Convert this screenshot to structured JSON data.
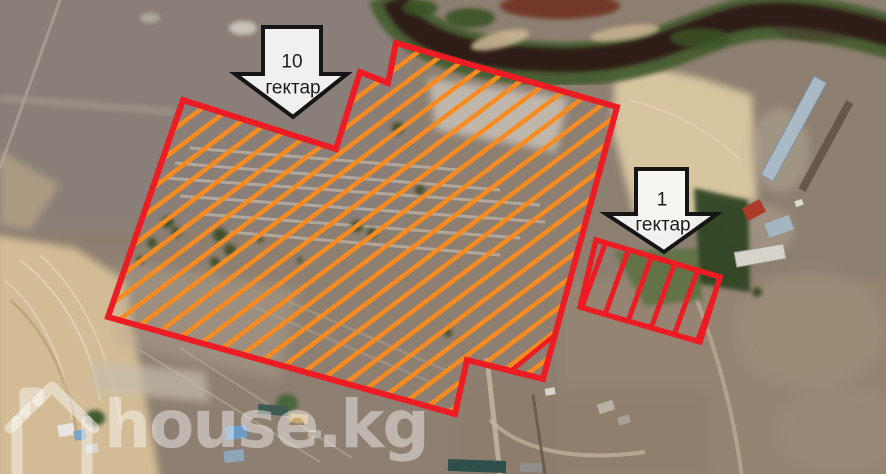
{
  "map": {
    "watermark": {
      "text": "house.kg",
      "icon": "house-outline-icon"
    },
    "plots": [
      {
        "id": "plot-large",
        "label_value": "10",
        "label_unit": "гектар",
        "outline_color": "#ed1c24",
        "hatch_color": "#f78b1f"
      },
      {
        "id": "plot-small",
        "label_value": "1",
        "label_unit": "гектар",
        "outline_color": "#ed1c24",
        "hatch_color": "#ed1c24"
      }
    ],
    "arrow_style": {
      "fill": "#f8f6f3",
      "border": "#151515"
    }
  }
}
